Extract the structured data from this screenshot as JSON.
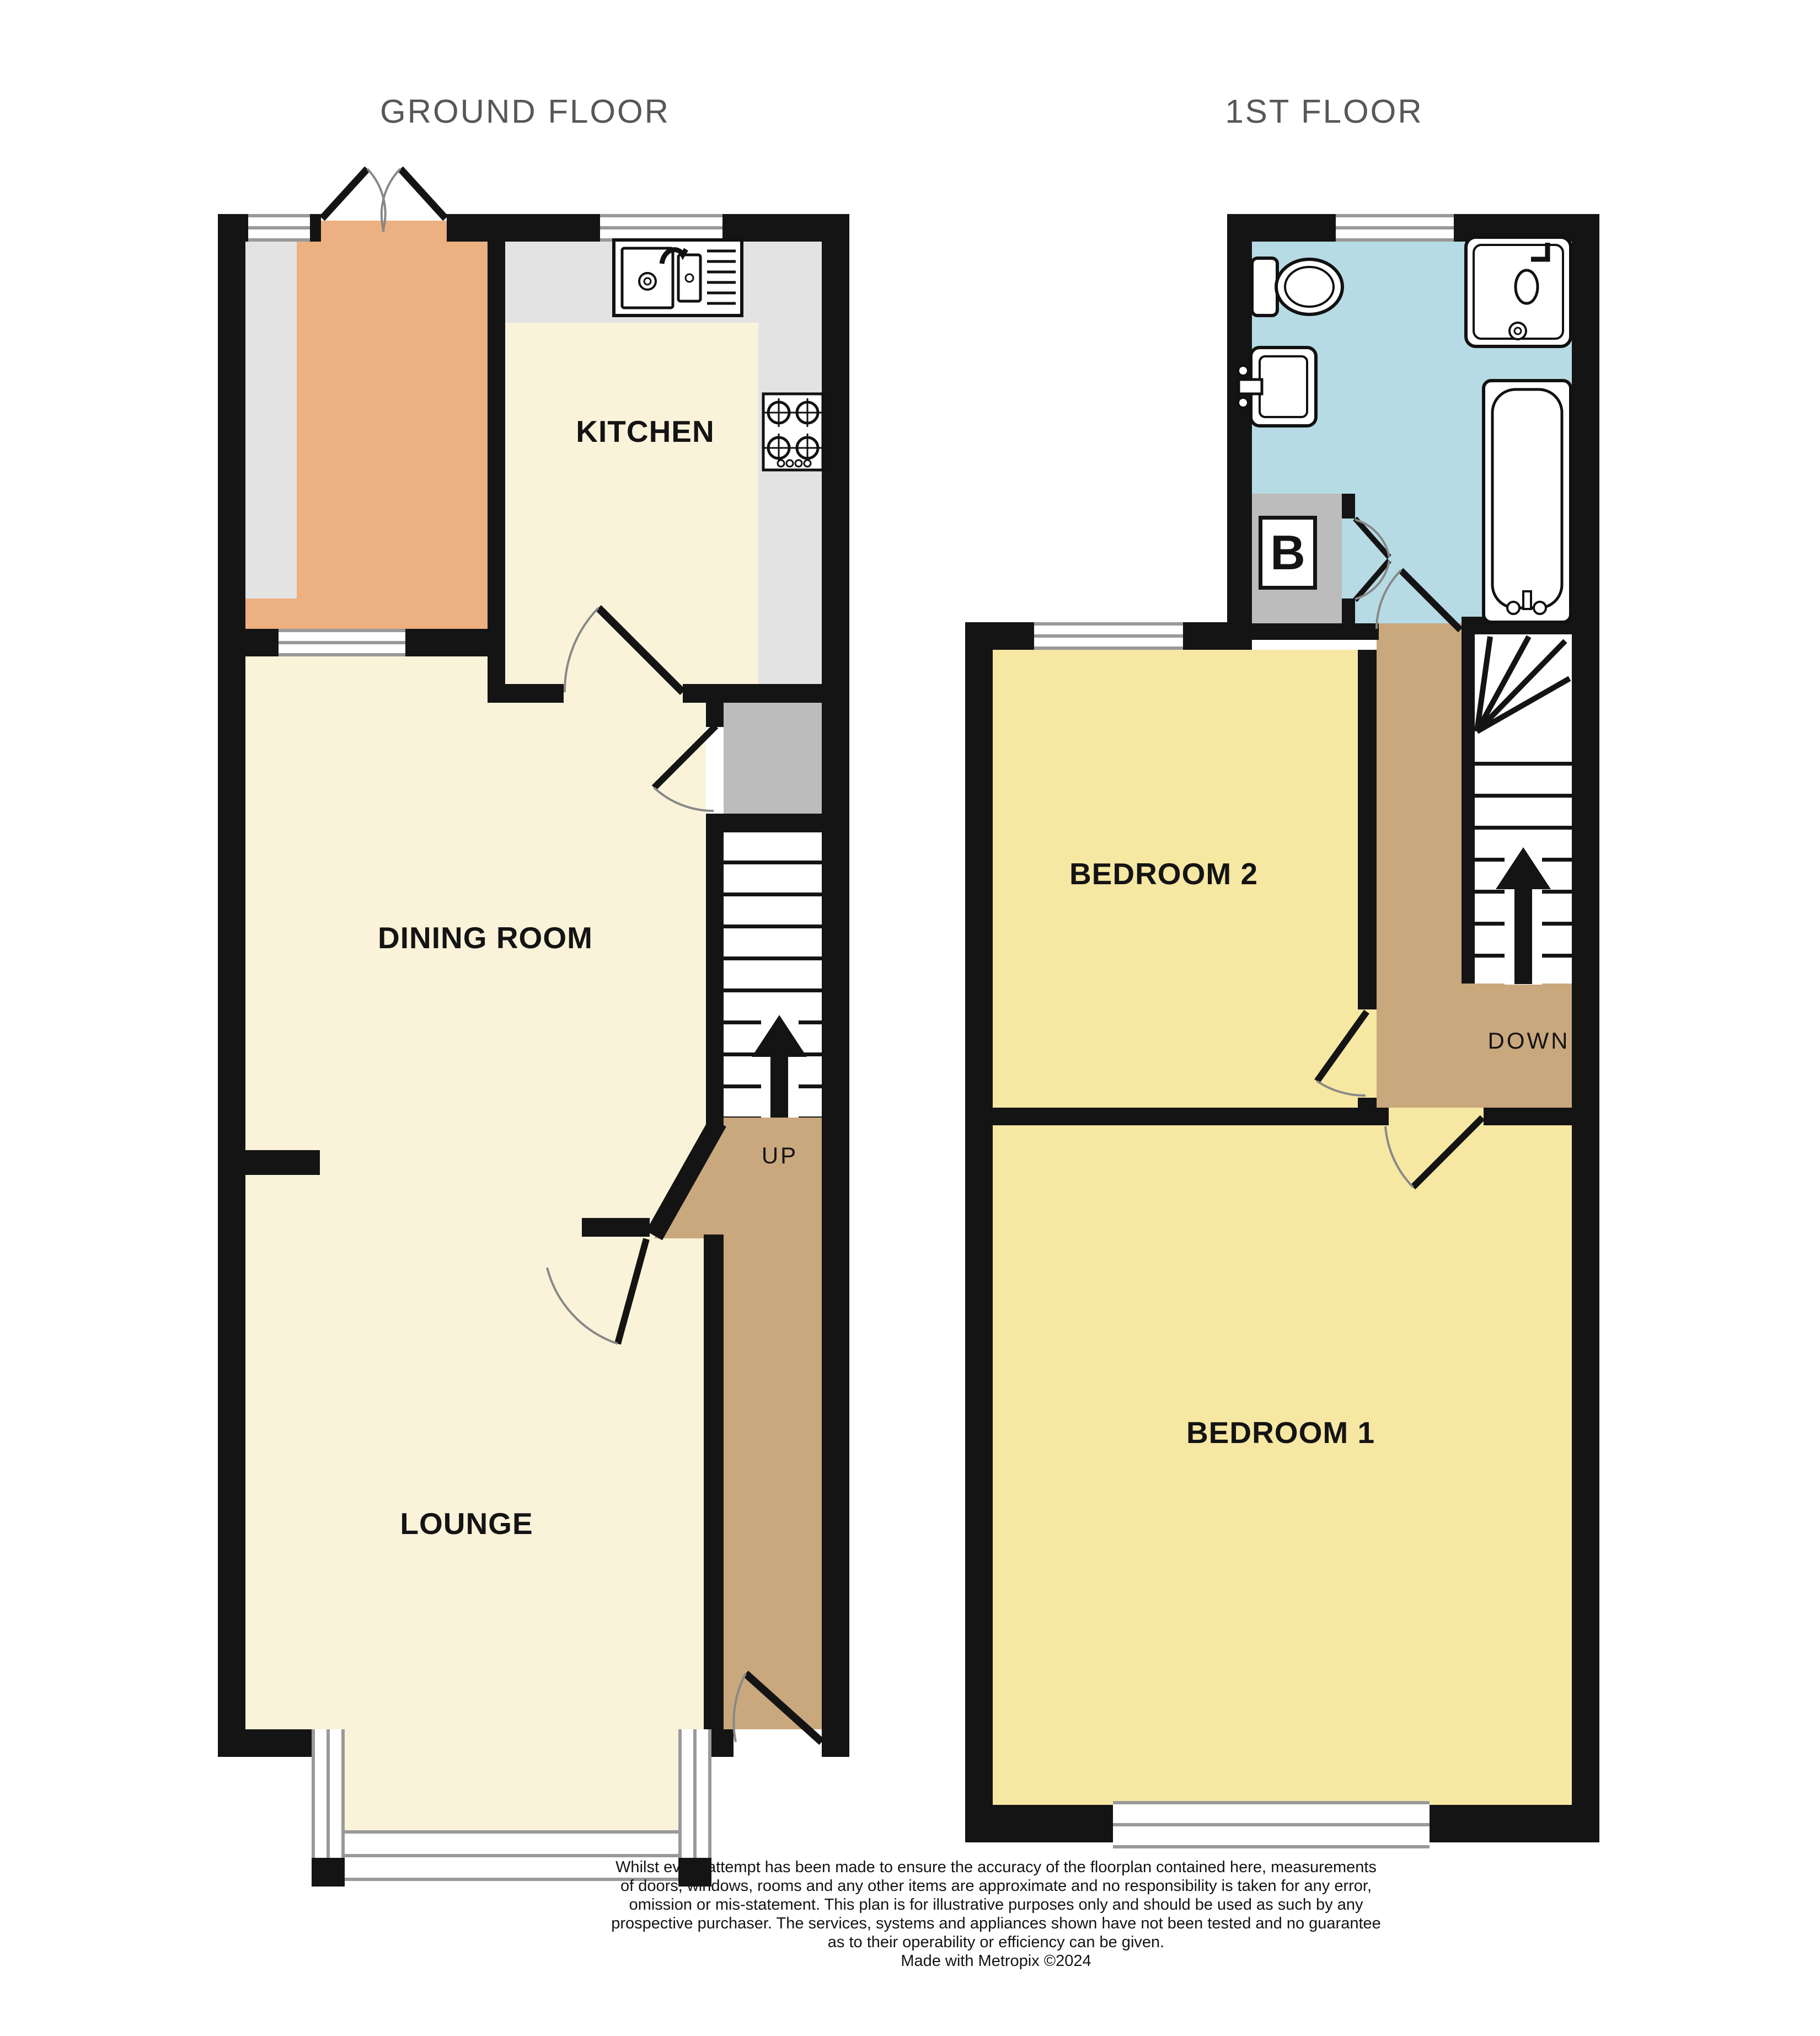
{
  "titles": {
    "ground_floor": "GROUND FLOOR",
    "first_floor": "1ST FLOOR"
  },
  "rooms": {
    "kitchen": "KITCHEN",
    "dining_room": "DINING ROOM",
    "lounge": "LOUNGE",
    "bedroom2": "BEDROOM 2",
    "bedroom1": "BEDROOM 1"
  },
  "stairs": {
    "up": "UP",
    "down": "DOWN"
  },
  "boiler_label": "B",
  "disclaimer": {
    "lines": [
      "Whilst every attempt has been made to ensure the accuracy of the floorplan contained here, measurements",
      "of doors, windows, rooms and any other items are approximate and no responsibility is taken for any error,",
      "omission or mis-statement. This plan is for illustrative purposes only and should be used as such by any",
      "prospective purchaser. The services, systems and appliances shown have not been tested and no guarantee",
      "as to their operability or efficiency can be given.",
      "Made with Metropix ©2024"
    ]
  },
  "icons": [
    "kitchen-sink-icon",
    "stove-icon",
    "toilet-icon",
    "basin-icon",
    "shower-icon",
    "bath-icon",
    "up-arrow-icon",
    "down-arrow-icon",
    "door-swing-icon",
    "double-door-icon"
  ],
  "colors": {
    "wall": "#141414",
    "cream_floor": "#faf3da",
    "orange_floor": "#ecb081",
    "yellow_floor": "#f6e7a3",
    "blue_floor": "#b7dbe4",
    "brown_floor": "#c9a87d",
    "counter_gray": "#e3e3e3",
    "closet_gray": "#bcbcbc",
    "window_line": "#999999",
    "title_text": "#575757"
  }
}
